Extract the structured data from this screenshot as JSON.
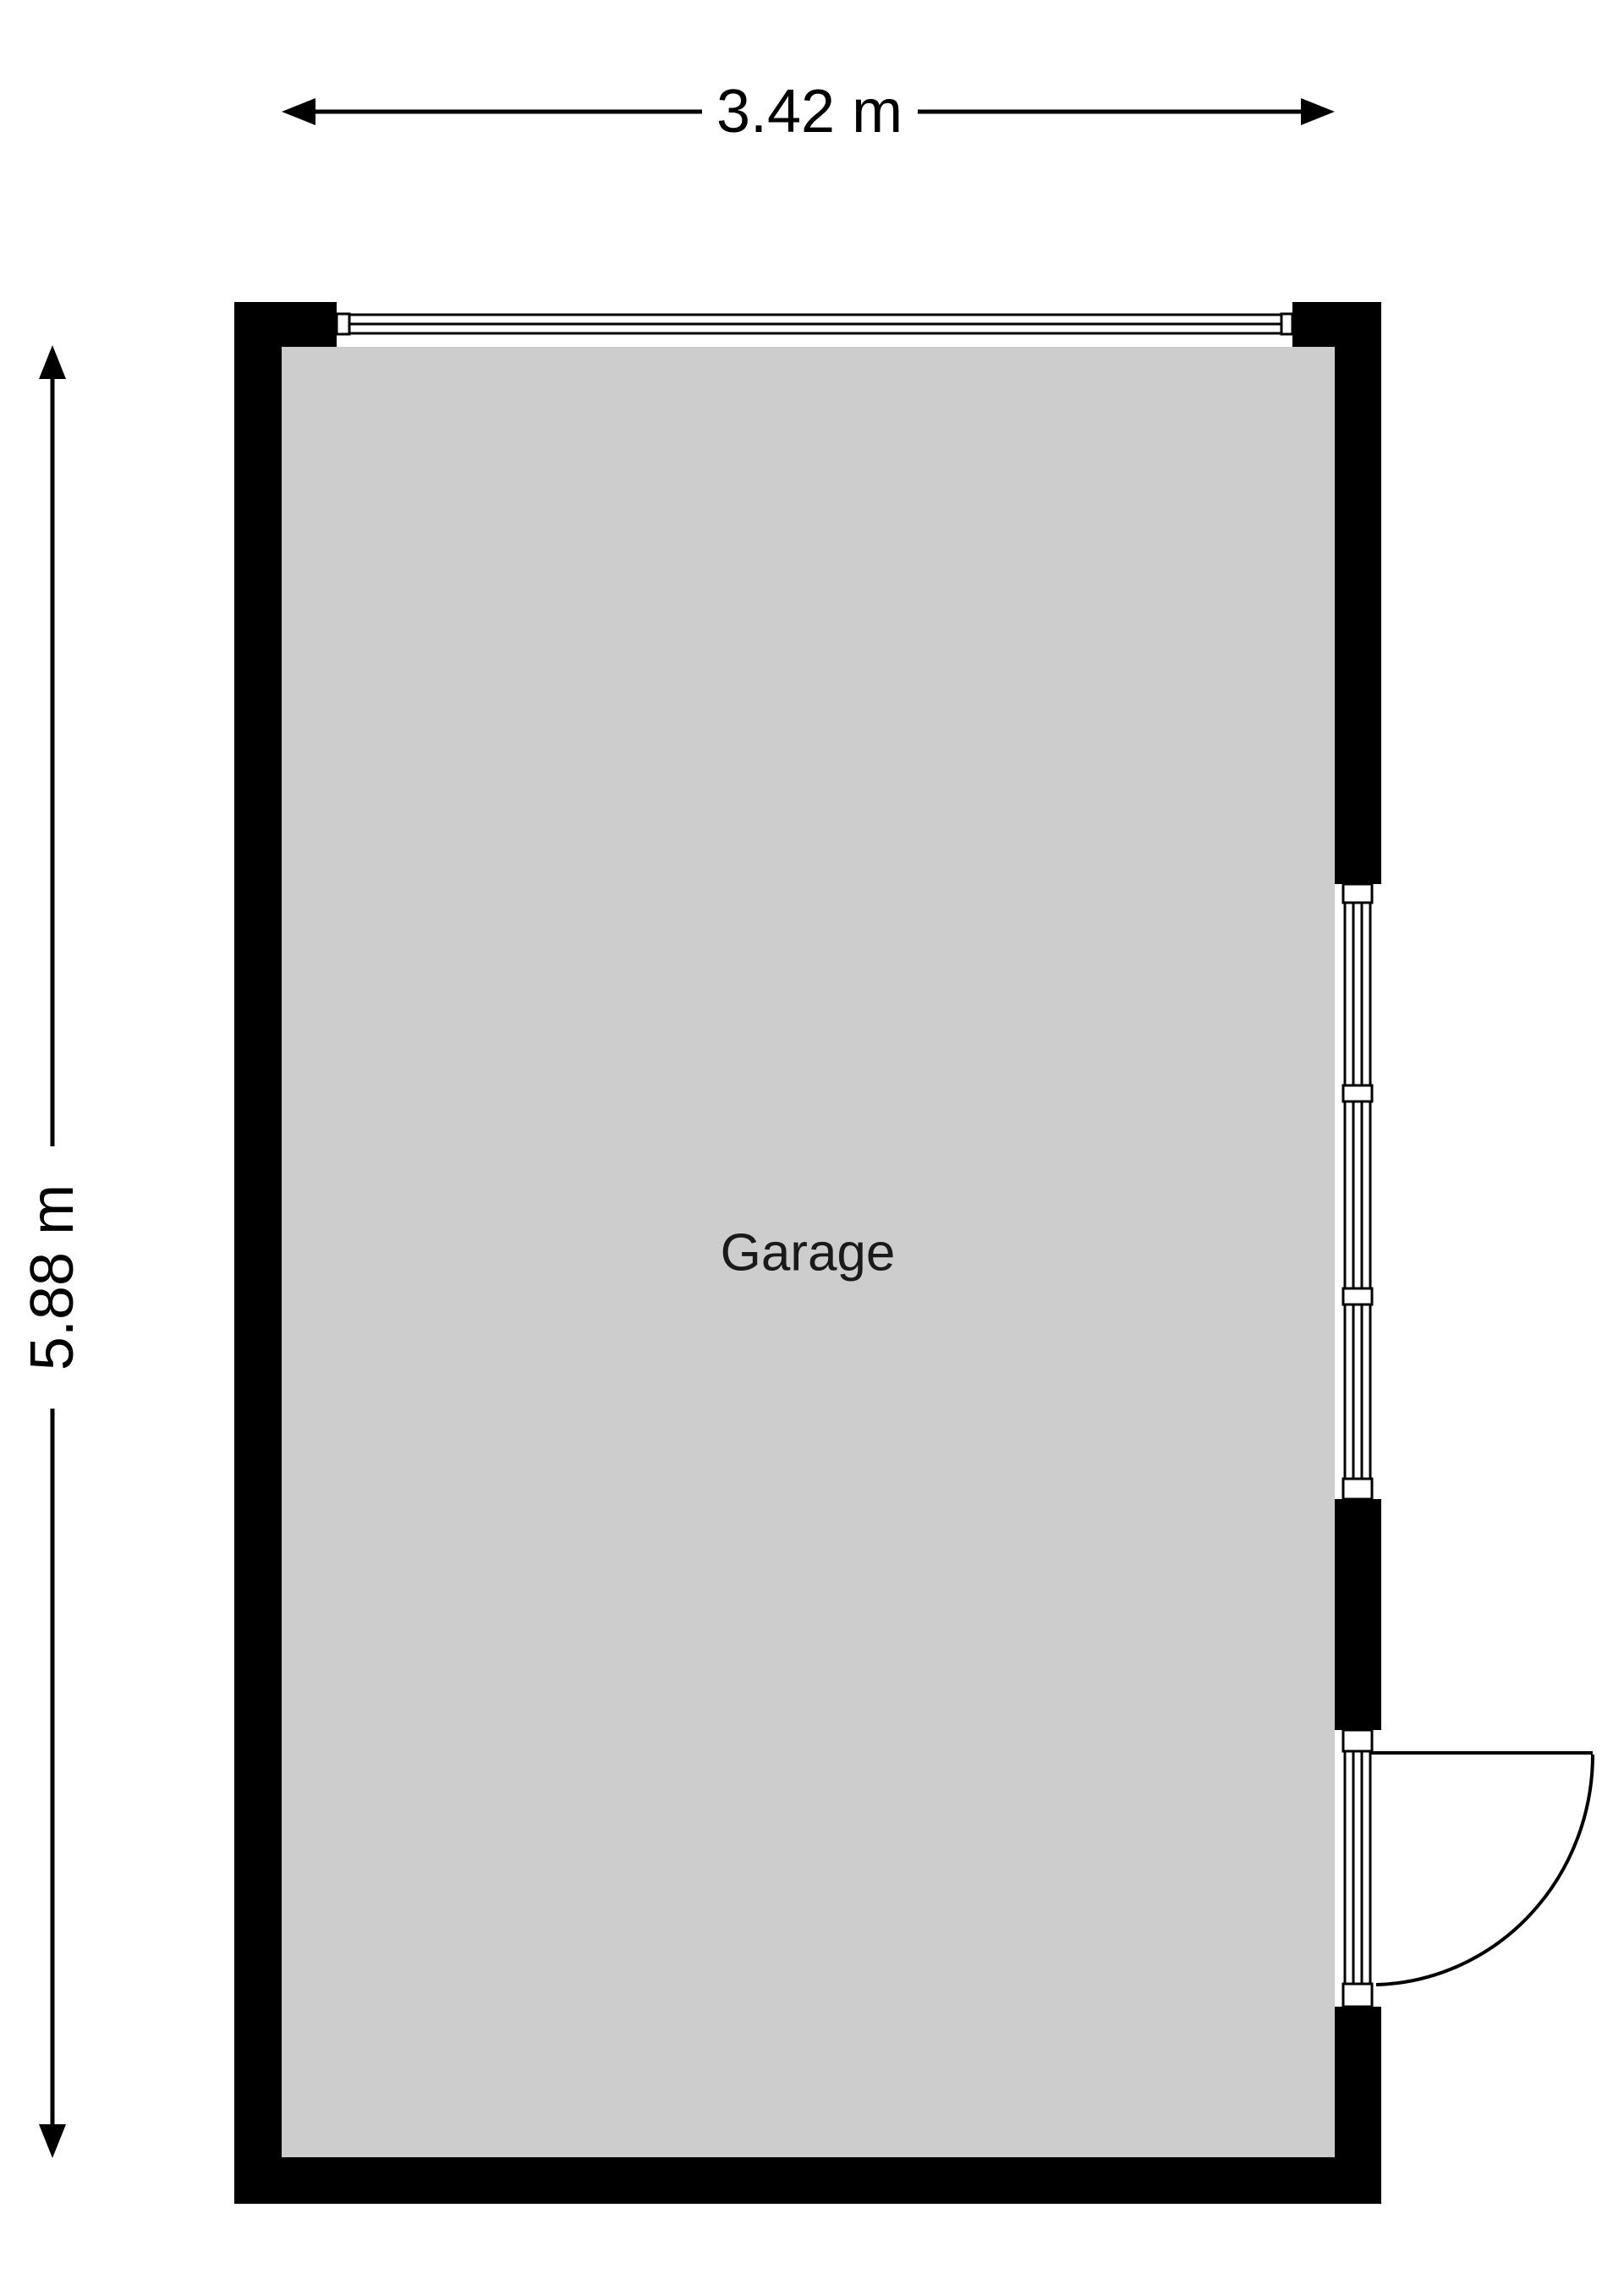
{
  "floorplan": {
    "room": {
      "label": "Garage"
    },
    "dimensions": {
      "width": "3.42 m",
      "height": "5.88 m"
    },
    "colors": {
      "background": "#ffffff",
      "wall": "#000000",
      "floor": "#cdcdcd",
      "line": "#000000"
    },
    "features": [
      "garage-door-top",
      "window-right",
      "single-swing-door-bottom-right"
    ]
  }
}
